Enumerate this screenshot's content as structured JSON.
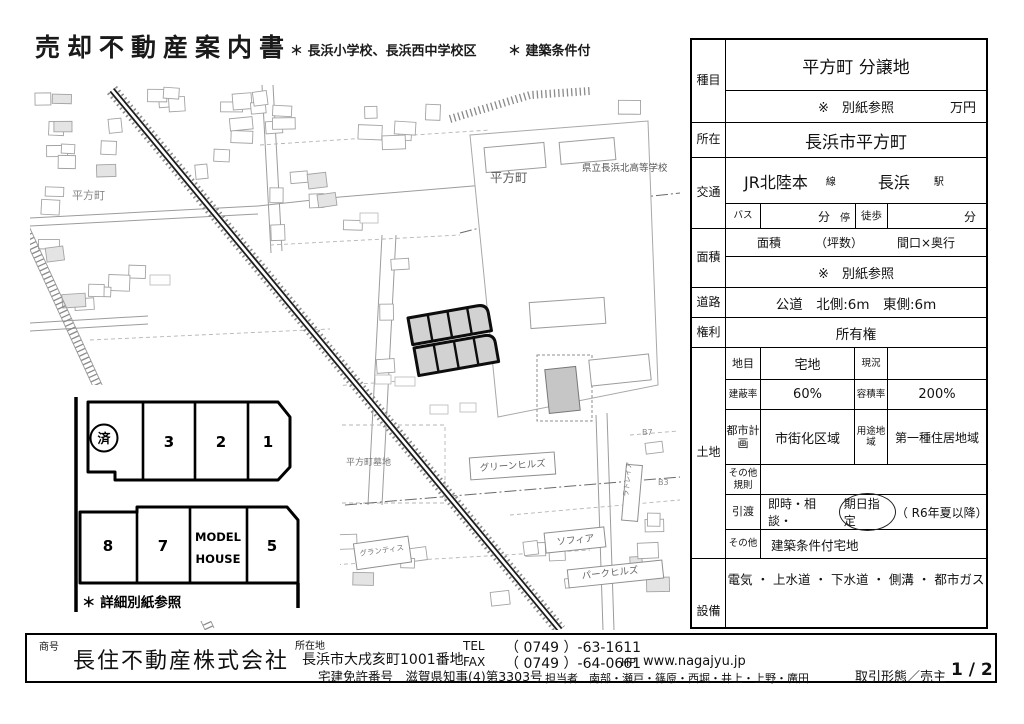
{
  "header": {
    "title": "売却不動産案内書",
    "note1": "＊ 長浜小学校、長浜西中学校区",
    "note2": "＊ 建築条件付"
  },
  "table": {
    "shumoku": {
      "label": "種目",
      "value": "平方町 分譲地",
      "price_note": "※　別紙参照",
      "price_unit": "万円"
    },
    "shozai": {
      "label": "所在",
      "value": "長浜市平方町"
    },
    "kotsu": {
      "label": "交通",
      "line": "JR北陸本",
      "line_unit": "線",
      "station": "長浜",
      "station_unit": "駅",
      "bus_label": "バス",
      "bus_min": "分",
      "bus_stop": "停",
      "walk_label": "徒歩",
      "walk_min": "分"
    },
    "menseki": {
      "label": "面積",
      "h1": "面積",
      "h2": "（坪数）",
      "h3": "間口×奥行",
      "value": "※　別紙参照"
    },
    "doro": {
      "label": "道路",
      "value": "公道　北側:6m　東側:6m"
    },
    "kenri": {
      "label": "権利",
      "value": "所有権"
    },
    "tochi": {
      "label": "土地",
      "chimoku": {
        "label": "地目",
        "value": "宅地",
        "label2": "現況",
        "value2": ""
      },
      "kenpei": {
        "label": "建蔽率",
        "value": "60%",
        "label2": "容積率",
        "value2": "200%"
      },
      "toshi": {
        "label": "都市計画",
        "value": "市街化区域",
        "label2": "用途地域",
        "value2": "第一種住居地域"
      },
      "kisoku": {
        "label": "その他規則",
        "value": ""
      },
      "hikiwatashi": {
        "label": "引渡",
        "pre": "即時・相談・",
        "circled": "期日指定",
        "post": "（ R6年夏以降）"
      },
      "sonota": {
        "label": "その他",
        "value": "建築条件付宅地"
      }
    },
    "setsubi": {
      "label": "設備",
      "value": "電気 ・ 上水道 ・ 下水道 ・ 側溝 ・ 都市ガス"
    }
  },
  "map": {
    "labels": {
      "town_left": "平方町",
      "town_center": "平方町",
      "school": "県立長浜北高等学校",
      "cemetery": "平方町墓地",
      "green_hills": "グリーンヒルズ",
      "sophia": "ソフィア",
      "park_hills": "パークヒルズ",
      "grantis": "グランティス",
      "latreia": "ラトレイア",
      "b3": "B3",
      "b7": "B7"
    },
    "inset": {
      "top_lots": [
        "済",
        "3",
        "2",
        "1"
      ],
      "bottom_lots": [
        "8",
        "7",
        "5"
      ],
      "model_house_line1": "MODEL",
      "model_house_line2": "HOUSE",
      "caption": "＊ 詳細別紙参照"
    }
  },
  "footer": {
    "shogo_label": "商号",
    "company": "長住不動産株式会社",
    "address_label": "所在地",
    "address": "長浜市大戌亥町1001番地",
    "license": "宅建免許番号　滋賀県知事(4)第3303号",
    "tel_label": "TEL",
    "tel": "（ 0749 ）-63-1611",
    "fax_label": "FAX",
    "fax": "（ 0749 ）-64-0661",
    "hp_label": "HP",
    "hp": "www.nagajyu.jp",
    "staff": "担当者　南部・瀬戸・篠原・西堀・井上・上野・廣田",
    "deal": "取引形態／売主",
    "page": "1 / 2"
  }
}
